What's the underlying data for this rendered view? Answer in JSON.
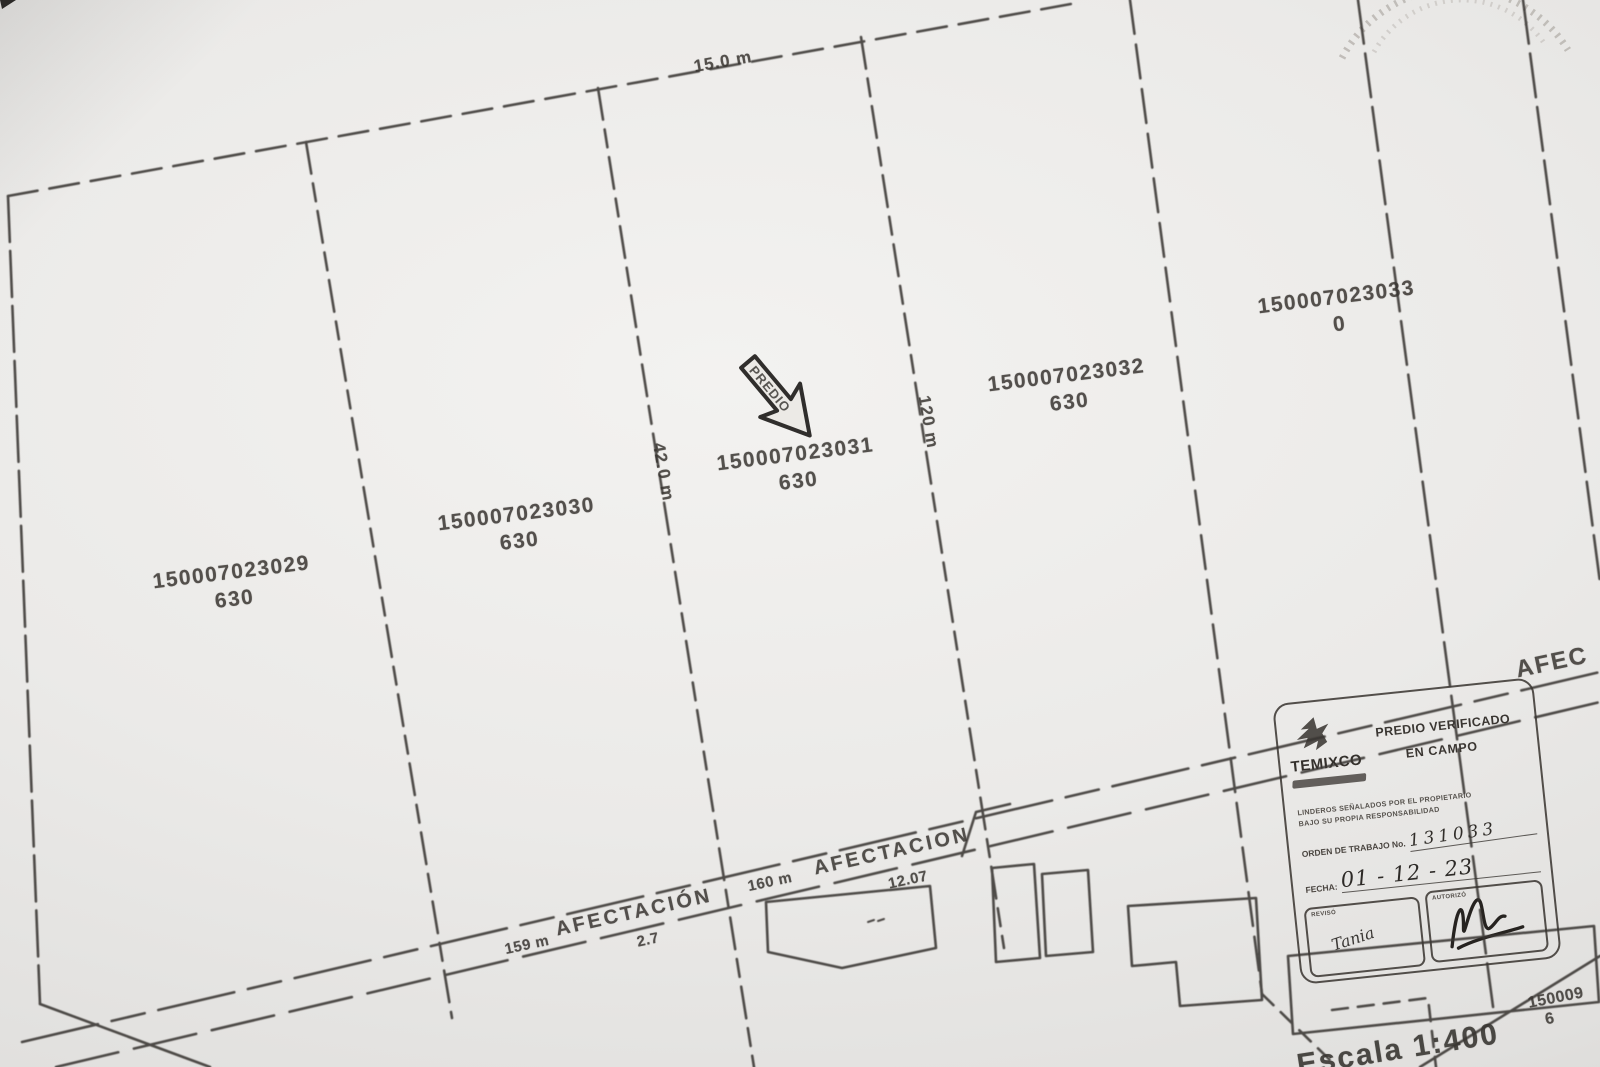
{
  "map": {
    "top_dimension_label": "15.0 m",
    "parcels": [
      {
        "id": "150007023029",
        "area": "630"
      },
      {
        "id": "150007023030",
        "area": "630"
      },
      {
        "id": "150007023031",
        "area": "630"
      },
      {
        "id": "150007023032",
        "area": "630"
      },
      {
        "id": "150007023033",
        "area": "0"
      }
    ],
    "side_dimension_left": "42.0 m",
    "side_dimension_right": "120 m",
    "arrow_stamp_text": "PREDIO",
    "afectacion_upper": {
      "label": "AFECTACION",
      "value": "12.07",
      "segment_length": "160 m"
    },
    "afectacion_lower": {
      "label": "AFECTACIÓN",
      "value": "2.7",
      "segment_length": "159 m"
    },
    "right_edge_label": "AFEC",
    "bottom_right_parcel_id": "150009",
    "bottom_right_parcel_sub": "6",
    "scale_label": "Escala 1:400"
  },
  "stamp": {
    "org_name": "TEMIXCO",
    "verified_line1": "PREDIO VERIFICADO",
    "verified_line2": "EN CAMPO",
    "disclaimer_line1": "LINDEROS SEÑALADOS POR EL PROPIETARIO",
    "disclaimer_line2": "BAJO SU PROPIA RESPONSABILIDAD",
    "order_label": "ORDEN DE TRABAJO No.",
    "order_value": "131033",
    "date_label": "FECHA:",
    "date_value": "01 - 12 - 23",
    "reviewed_label": "REVISÓ",
    "reviewed_value": "Tania",
    "authorized_label": "AUTORIZÓ"
  }
}
